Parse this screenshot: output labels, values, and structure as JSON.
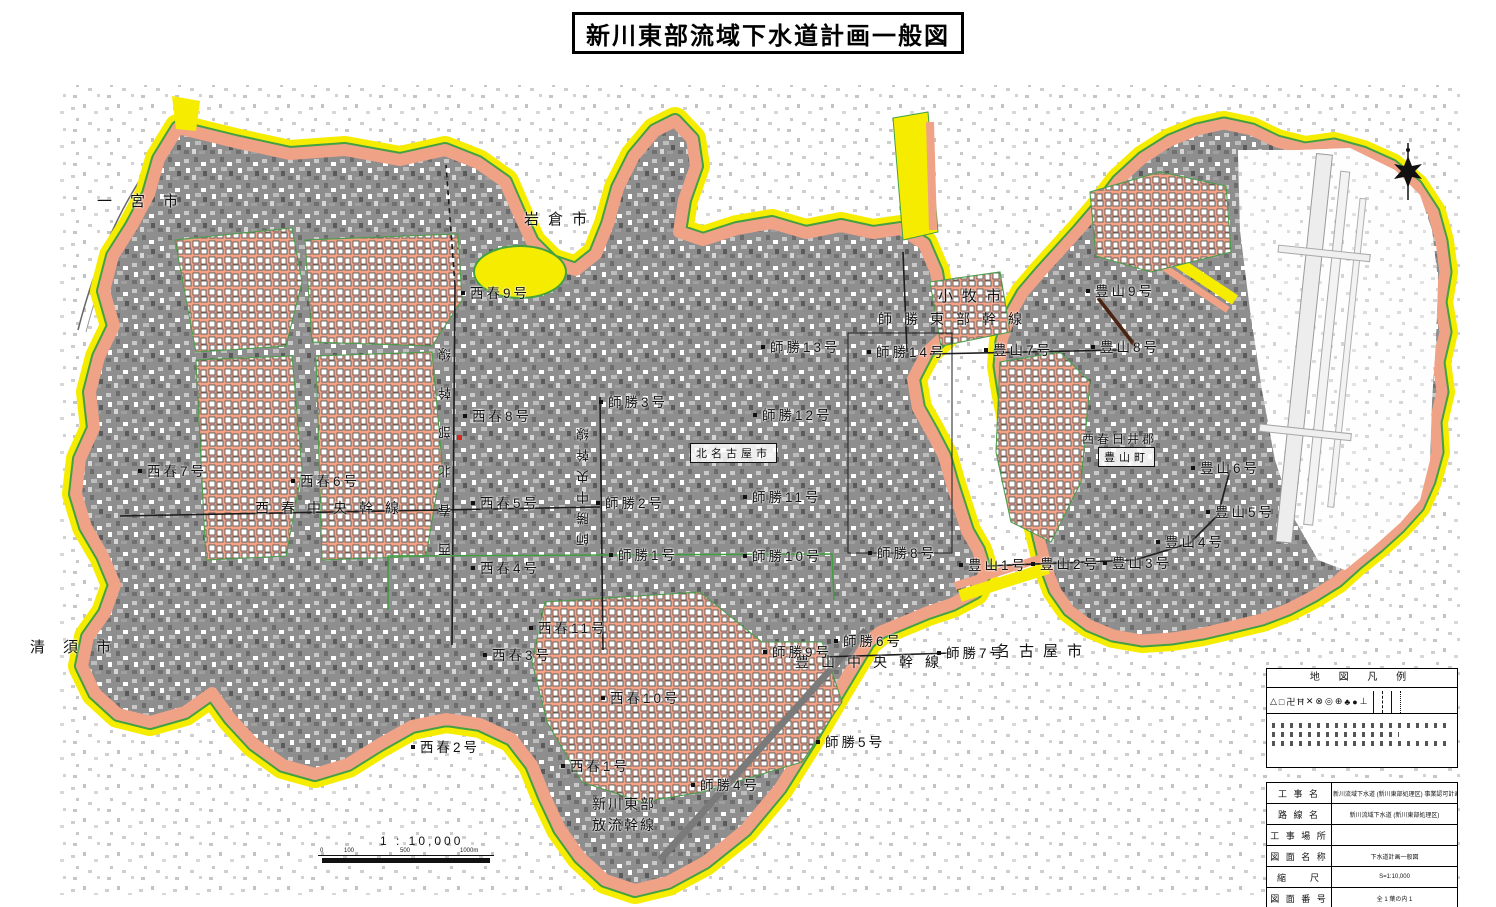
{
  "title": "新川東部流域下水道計画一般図",
  "scale": {
    "text": "1 : 10,000",
    "ticks": [
      "0",
      "100",
      "500",
      "1000m"
    ]
  },
  "legend": {
    "title": "地 図 凡 例",
    "symbols": [
      "△",
      "□",
      "卍",
      "Ħ",
      "✕",
      "⊗",
      "◎",
      "⊕",
      "♣",
      "●",
      "⊥"
    ]
  },
  "info_table": {
    "rows": [
      {
        "label": "工 事 名",
        "value": "新川流域下水道 (新川東部処理区) 事業認可計画"
      },
      {
        "label": "路 線 名",
        "value": "新川流域下水道 (新川東部処理区)"
      },
      {
        "label": "工 事 場 所",
        "value": ""
      },
      {
        "label": "図 面 名 称",
        "value": "下水道計画一般図"
      },
      {
        "label": "縮　　尺",
        "value": "S=1:10,000"
      },
      {
        "label": "図 面 番 号",
        "value": "全 1 葉の内 1"
      }
    ]
  },
  "map": {
    "labels": [
      {
        "t": "一宮市",
        "x": 97,
        "y": 190,
        "cls": "cityw",
        "name": "city-label-ichinomiya"
      },
      {
        "t": "岩倉市",
        "x": 524,
        "y": 208,
        "cls": "city",
        "name": "city-label-iwakura"
      },
      {
        "t": "小牧市",
        "x": 938,
        "y": 285,
        "cls": "city",
        "name": "city-label-komaki"
      },
      {
        "t": "清須市",
        "x": 30,
        "y": 636,
        "cls": "cityw",
        "name": "city-label-kiyosu"
      },
      {
        "t": "名古屋市",
        "x": 995,
        "y": 640,
        "cls": "city",
        "name": "city-label-nagoya"
      },
      {
        "t": "西春日井郡",
        "x": 1082,
        "y": 430,
        "cls": "area",
        "name": "district-label-nishikasugai"
      },
      {
        "t": "豊山町",
        "x": 1098,
        "y": 447,
        "cls": "boxed",
        "name": "town-label-toyoyama"
      },
      {
        "t": "北名古屋市",
        "x": 690,
        "y": 443,
        "cls": "boxed",
        "name": "city-label-kitanagoya"
      },
      {
        "t": "師勝東部幹線",
        "x": 878,
        "y": 309,
        "cls": "trunk",
        "name": "trunk-label-shikatsu-tobu"
      },
      {
        "t": "西春中央幹線",
        "x": 255,
        "y": 498,
        "cls": "trunk",
        "name": "trunk-label-nishiharu-chuo"
      },
      {
        "t": "豊山中央幹線",
        "x": 795,
        "y": 652,
        "cls": "trunk",
        "name": "trunk-label-toyoyama-chuo"
      },
      {
        "t": "新川東部",
        "x": 592,
        "y": 794,
        "cls": "trunk2",
        "name": "trunk-label-shinkawa-tobu"
      },
      {
        "t": "放流幹線",
        "x": 592,
        "y": 815,
        "cls": "trunk2",
        "name": "trunk-label-horyu-kansen"
      },
      {
        "t": "西春北部幹線",
        "x": 436,
        "y": 322,
        "cls": "vertw",
        "name": "trunk-label-nishiharu-hokubu"
      },
      {
        "t": "師勝中央幹線",
        "x": 574,
        "y": 420,
        "cls": "vert",
        "name": "trunk-label-shikatsu-chuo"
      },
      {
        "t": "西春9号",
        "x": 470,
        "y": 282,
        "cls": "point"
      },
      {
        "t": "西春8号",
        "x": 472,
        "y": 405,
        "cls": "point"
      },
      {
        "t": "西春7号",
        "x": 147,
        "y": 460,
        "cls": "point"
      },
      {
        "t": "西春6号",
        "x": 300,
        "y": 470,
        "cls": "point"
      },
      {
        "t": "西春5号",
        "x": 480,
        "y": 492,
        "cls": "point"
      },
      {
        "t": "西春4号",
        "x": 480,
        "y": 557,
        "cls": "point"
      },
      {
        "t": "西春3号",
        "x": 492,
        "y": 644,
        "cls": "point"
      },
      {
        "t": "西春2号",
        "x": 420,
        "y": 736,
        "cls": "point"
      },
      {
        "t": "西春1号",
        "x": 570,
        "y": 755,
        "cls": "point"
      },
      {
        "t": "西春11号",
        "x": 538,
        "y": 617,
        "cls": "point"
      },
      {
        "t": "西春10号",
        "x": 610,
        "y": 687,
        "cls": "point"
      },
      {
        "t": "師勝3号",
        "x": 608,
        "y": 391,
        "cls": "point"
      },
      {
        "t": "師勝2号",
        "x": 605,
        "y": 492,
        "cls": "point"
      },
      {
        "t": "師勝1号",
        "x": 618,
        "y": 544,
        "cls": "point"
      },
      {
        "t": "師勝13号",
        "x": 770,
        "y": 336,
        "cls": "point"
      },
      {
        "t": "師勝14号",
        "x": 876,
        "y": 341,
        "cls": "point"
      },
      {
        "t": "師勝12号",
        "x": 762,
        "y": 404,
        "cls": "point"
      },
      {
        "t": "師勝11号",
        "x": 752,
        "y": 486,
        "cls": "point"
      },
      {
        "t": "師勝10号",
        "x": 752,
        "y": 545,
        "cls": "point"
      },
      {
        "t": "師勝8号",
        "x": 877,
        "y": 542,
        "cls": "point"
      },
      {
        "t": "師勝9号",
        "x": 772,
        "y": 641,
        "cls": "point"
      },
      {
        "t": "師勝6号",
        "x": 843,
        "y": 630,
        "cls": "point"
      },
      {
        "t": "師勝7号",
        "x": 946,
        "y": 642,
        "cls": "point"
      },
      {
        "t": "師勝5号",
        "x": 825,
        "y": 731,
        "cls": "point"
      },
      {
        "t": "師勝4号",
        "x": 700,
        "y": 774,
        "cls": "point"
      },
      {
        "t": "豊山9号",
        "x": 1095,
        "y": 280,
        "cls": "point"
      },
      {
        "t": "豊山7号",
        "x": 993,
        "y": 339,
        "cls": "point"
      },
      {
        "t": "豊山8号",
        "x": 1100,
        "y": 336,
        "cls": "point"
      },
      {
        "t": "豊山6号",
        "x": 1200,
        "y": 457,
        "cls": "point"
      },
      {
        "t": "豊山5号",
        "x": 1215,
        "y": 501,
        "cls": "point"
      },
      {
        "t": "豊山4号",
        "x": 1165,
        "y": 531,
        "cls": "point"
      },
      {
        "t": "豊山1号",
        "x": 968,
        "y": 554,
        "cls": "point"
      },
      {
        "t": "豊山2号",
        "x": 1040,
        "y": 553,
        "cls": "point"
      },
      {
        "t": "豊山3号",
        "x": 1112,
        "y": 552,
        "cls": "point"
      }
    ]
  }
}
